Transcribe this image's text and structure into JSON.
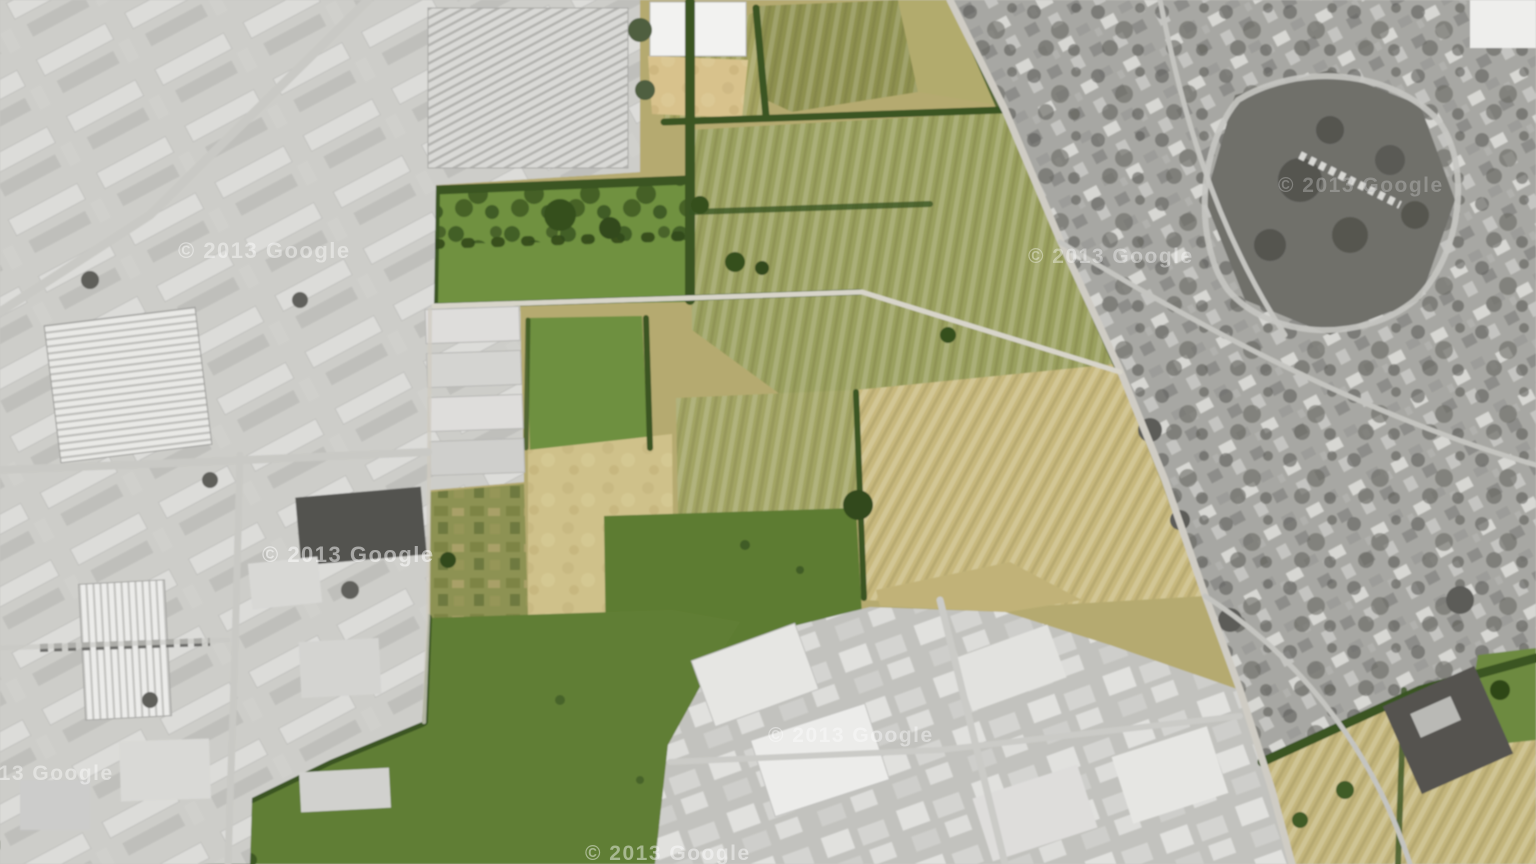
{
  "map": {
    "view": "satellite",
    "provider": "Google",
    "imagery_year": "2013",
    "watermark_text": "© 2013 Google",
    "palette": {
      "base_gray": "#c6c6c2",
      "industrial_gray": "#cdcdc9",
      "residential_gray": "#a7a7a3",
      "park_gray": "#6f6f6a",
      "bottom_industrial_gray": "#c2c2be",
      "farm_base_tan": "#b5aa70",
      "crop_olive": "#9aa05e",
      "crop_olive_light": "#a3a25f",
      "crop_olive_dark": "#8e9150",
      "crop_tan": "#c7b87d",
      "crop_pale": "#cfc18a",
      "meadow_green": "#6e9040",
      "field_green": "#5d7c33",
      "lower_green": "#617e35",
      "allotment_green": "#8d9253",
      "hedge_green": "#3a5522",
      "sandy_tan": "#d8c28c",
      "road_light": "#d6d3c8",
      "se_field_tan": "#c3b57c"
    }
  }
}
